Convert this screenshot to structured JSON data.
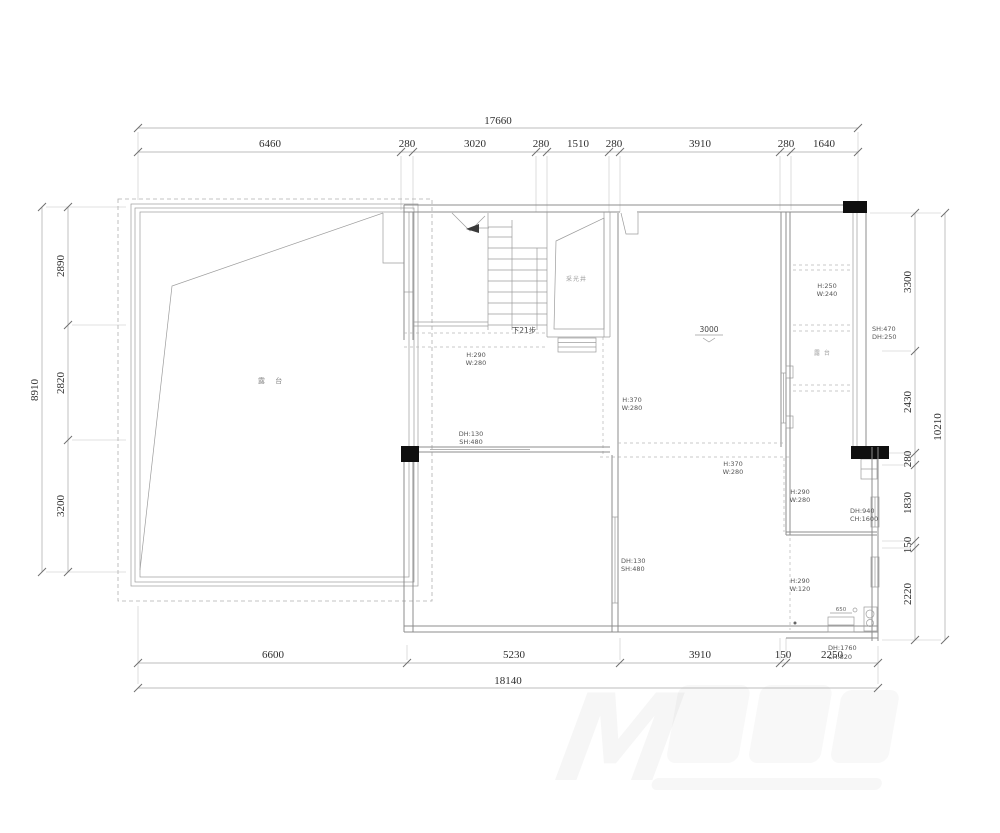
{
  "dims": {
    "top": {
      "total": "17660",
      "segments": [
        "6460",
        "280",
        "3020",
        "280",
        "1510",
        "280",
        "3910",
        "280",
        "1640"
      ]
    },
    "bottom": {
      "total": "18140",
      "segments": [
        "6600",
        "5230",
        "3910",
        "150",
        "2250"
      ]
    },
    "left": {
      "total": "8910",
      "segments": [
        "2890",
        "2820",
        "3200"
      ]
    },
    "right": {
      "total": "10210",
      "segments": [
        "3300",
        "2430",
        "280",
        "1830",
        "150",
        "2220"
      ]
    }
  },
  "rooms": {
    "terrace": "露 台",
    "east_terrace": "露 台",
    "light_well": "采光井"
  },
  "labels": {
    "stair_note": "下21步",
    "elevation": "3000",
    "cabinet_dim": "650",
    "watermark_letter": "M"
  },
  "openings": {
    "under_stair": {
      "l1": "H:290",
      "l2": "W:280"
    },
    "corridor_window": {
      "l1": "DH:130",
      "l2": "SH:480"
    },
    "left_room_window": {
      "l1": "DH:130",
      "l2": "SH:480"
    },
    "main_left": {
      "l1": "H:370",
      "l2": "W:280"
    },
    "main_bottom": {
      "l1": "H:370",
      "l2": "W:280"
    },
    "strip": {
      "l1": "H:250",
      "l2": "W:240"
    },
    "strip_window": {
      "l1": "SH:470",
      "l2": "DH:250"
    },
    "mid_right": {
      "l1": "H:290",
      "l2": "W:280"
    },
    "mid_right_window": {
      "l1": "DH:940",
      "l2": "CH:1600"
    },
    "bath": {
      "l1": "H:290",
      "l2": "W:120"
    },
    "bath_door": {
      "l1": "DH:1760",
      "l2": "CH:820"
    }
  },
  "colors": {
    "wall": "#8c8c8c",
    "column": "#0f0f0f",
    "dimension_text": "#2e2e2e"
  }
}
